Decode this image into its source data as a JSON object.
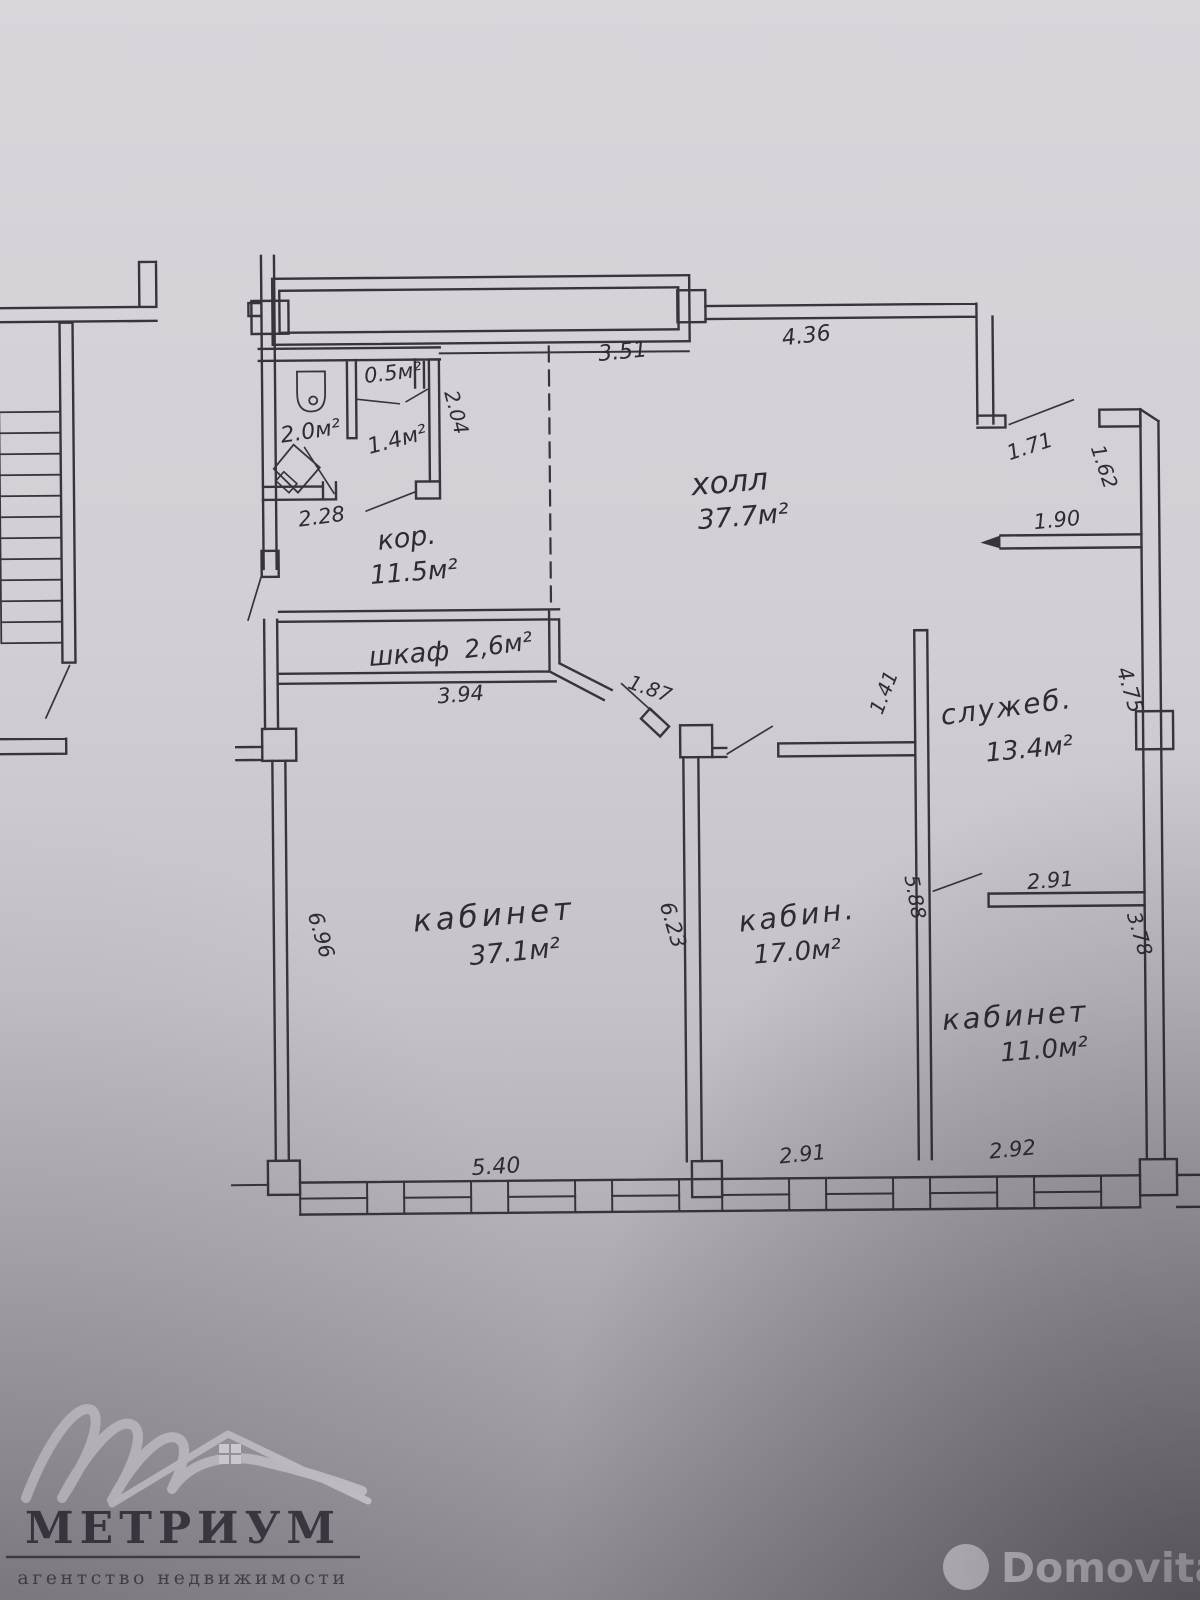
{
  "colors": {
    "paper_top": "#d9d5db",
    "paper_bottom": "#8e8991",
    "ink": "#38343c",
    "metrium_mark": "#c9c6cd",
    "metrium_text": "#3c3942",
    "domovita_text": "#edebf1"
  },
  "rooms": [
    {
      "id": "hall",
      "name": "холл",
      "area": "37.7м²"
    },
    {
      "id": "corridor",
      "name": "кор.",
      "area": "11.5м²"
    },
    {
      "id": "wardrobe",
      "name": "шкаф",
      "area": "2,6м²"
    },
    {
      "id": "office-large",
      "name": "кабинет",
      "area": "37.1м²"
    },
    {
      "id": "office-middle",
      "name": "кабин.",
      "area": "17.0м²"
    },
    {
      "id": "office-small",
      "name": "кабинет",
      "area": "11.0м²"
    },
    {
      "id": "service-room",
      "name": "служеб.",
      "area": "13.4м²"
    },
    {
      "id": "wc",
      "area": "2.0м²"
    },
    {
      "id": "vestibule",
      "area": "1.4м²"
    },
    {
      "id": "niche",
      "area": "0.5м²"
    }
  ],
  "dims": {
    "window_top": "3.51",
    "wall_top_right": "4.36",
    "door_hall_right": "1.71",
    "jamb_right": "1.62",
    "ledge_right": "1.90",
    "right_wall_upper": "4.75",
    "service_stub": "1.41",
    "service_width": "2.91",
    "office_small_height": "3.78",
    "office_middle_height": "5.88",
    "office_large_door": "1.87",
    "vestibule_height": "2.04",
    "wc_width": "2.28",
    "wardrobe_width": "3.94",
    "office_large_height_left": "6.96",
    "office_large_height_right": "6.23",
    "office_large_width": "5.40",
    "office_middle_width": "2.91",
    "office_small_width": "2.92"
  },
  "watermark": {
    "brand": "МЕТРИУМ",
    "tagline": "агентство недвижимости"
  },
  "footer": {
    "brand": "Domovita"
  }
}
